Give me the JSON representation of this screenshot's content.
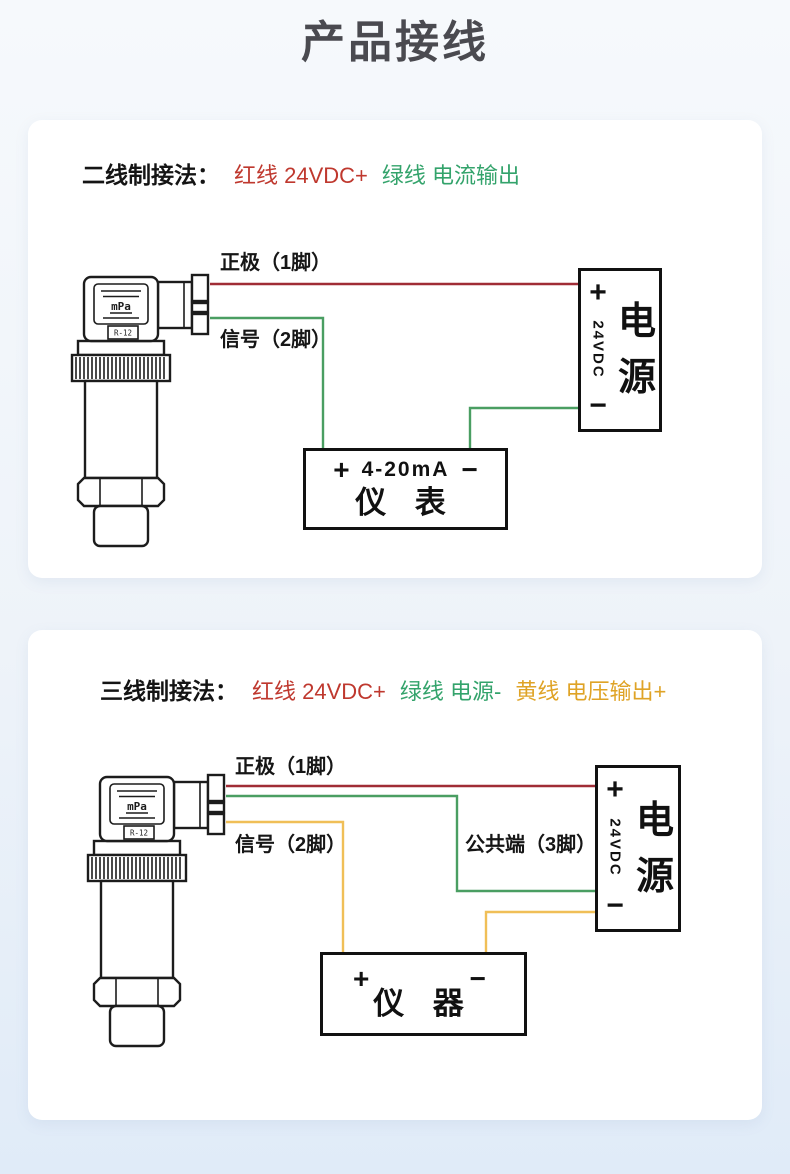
{
  "page": {
    "title": "产品接线"
  },
  "colors": {
    "wire-red": "#a02c36",
    "wire-green": "#4a9e62",
    "wire-yellow": "#f0bf57",
    "legend-red": "#bf382e",
    "legend-green": "#33a36b",
    "legend-yellow": "#dfa326",
    "title": "#4a4a50"
  },
  "two_wire": {
    "heading": "二线制接法：",
    "legend_red": "红线 24VDC+",
    "legend_green": "绿线 电流输出",
    "pin1_label": "正极（1脚）",
    "pin2_label": "信号（2脚）",
    "sensor": {
      "display": "mPa",
      "tag": "R-12"
    },
    "power_box": {
      "plus": "+",
      "voltage": "24VDC",
      "minus": "−",
      "name_top": "电",
      "name_bottom": "源"
    },
    "meter_box": {
      "plus": "+",
      "range": "4-20mA",
      "minus": "−",
      "name": "仪 表"
    }
  },
  "three_wire": {
    "heading": "三线制接法：",
    "legend_red": "红线 24VDC+",
    "legend_green": "绿线 电源-",
    "legend_yellow": "黄线 电压输出+",
    "pin1_label": "正极（1脚）",
    "pin2_label": "信号（2脚）",
    "pin3_label": "公共端（3脚）",
    "sensor": {
      "display": "mPa",
      "tag": "R-12"
    },
    "power_box": {
      "plus": "+",
      "voltage": "24VDC",
      "minus": "−",
      "name_top": "电",
      "name_bottom": "源"
    },
    "meter_box": {
      "plus": "+",
      "minus": "−",
      "name": "仪 器"
    }
  }
}
